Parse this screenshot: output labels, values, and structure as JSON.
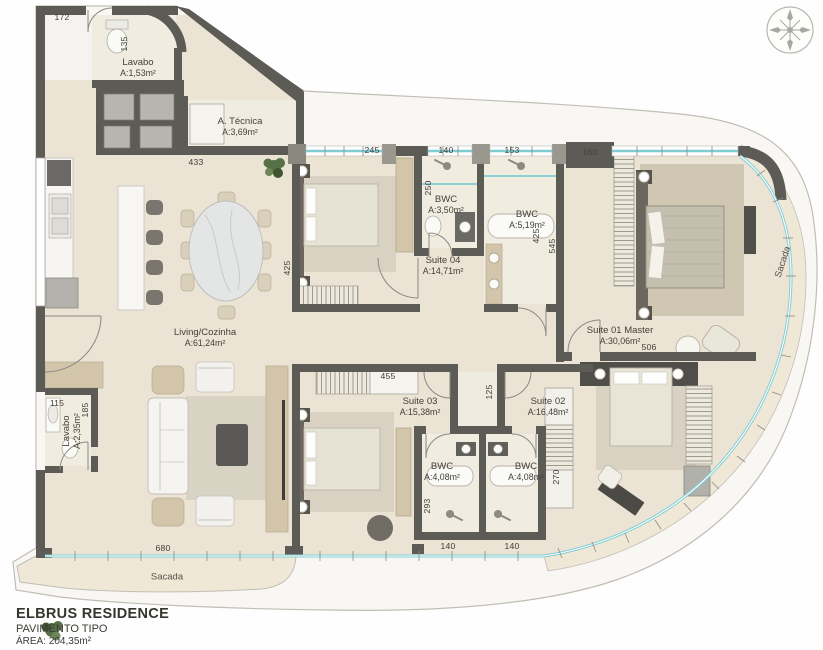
{
  "title_block": {
    "project": "ELBRUS RESIDENCE",
    "floor": "PAVIMENTO TIPO",
    "area": "ÁREA: 204,35m²"
  },
  "rooms": [
    {
      "id": "lavabo-upper",
      "name": "Lavabo",
      "area": "A:1,53m²"
    },
    {
      "id": "area-tecnica",
      "name": "A. Técnica",
      "area": "A:3,69m²"
    },
    {
      "id": "living-cozinha",
      "name": "Living/Cozinha",
      "area": "A:61,24m²"
    },
    {
      "id": "bwc-suite04",
      "name": "BWC",
      "area": "A:3,50m²"
    },
    {
      "id": "bwc-master",
      "name": "BWC",
      "area": "A:5,19m²"
    },
    {
      "id": "suite-04",
      "name": "Suite 04",
      "area": "A:14,71m²"
    },
    {
      "id": "suite-01-master",
      "name": "Suite 01 Master",
      "area": "A:30,06m²"
    },
    {
      "id": "suite-03",
      "name": "Suite 03",
      "area": "A:15,38m²"
    },
    {
      "id": "suite-02",
      "name": "Suite 02",
      "area": "A:16,48m²"
    },
    {
      "id": "bwc-suite03",
      "name": "BWC",
      "area": "A:4,08m²"
    },
    {
      "id": "bwc-suite02",
      "name": "BWC",
      "area": "A:4,08m²"
    },
    {
      "id": "lavabo-lower",
      "name": "Lavabo",
      "area": "A:2,35m²"
    }
  ],
  "balconies": [
    {
      "id": "sacada-bottom",
      "name": "Sacada"
    },
    {
      "id": "sacada-right",
      "name": "Sacada"
    }
  ],
  "dimensions": {
    "entry_top": "172",
    "lavabo_side": "135",
    "kitchen_top": "433",
    "suite04_top": "245",
    "bwc_suite04_top": "140",
    "bwc_master_top": "153",
    "master_top_left": "160",
    "bwc_suite04_side": "250",
    "suite04_side": "425",
    "master_side_a": "425",
    "master_side_b": "545",
    "master_bottom": "506",
    "suite03_top": "455",
    "hall_width": "125",
    "suite02_closet_side": "270",
    "bwc_suite03_side": "293",
    "bwc_suite03_bottom": "140",
    "bwc_suite02_bottom": "140",
    "lavabo_lower_top": "115",
    "lavabo_lower_side": "185",
    "living_bottom": "680"
  },
  "icons": {
    "compass": "compass-rose"
  },
  "colors": {
    "wall": "#5d5b56",
    "floor": "#ebe3d3",
    "floor_light": "#f1ece0",
    "window_glass": "#7fccd3",
    "slab": "#f8f7f3",
    "slab_line": "#c2beb5",
    "balcony": "#efe8d7",
    "wood": "#d2c5aa",
    "dark_furniture": "#55534e",
    "rug": "#d9d3c4",
    "fixture_white": "#fafaf7",
    "plant_green": "#567148",
    "ink": "#444139"
  }
}
